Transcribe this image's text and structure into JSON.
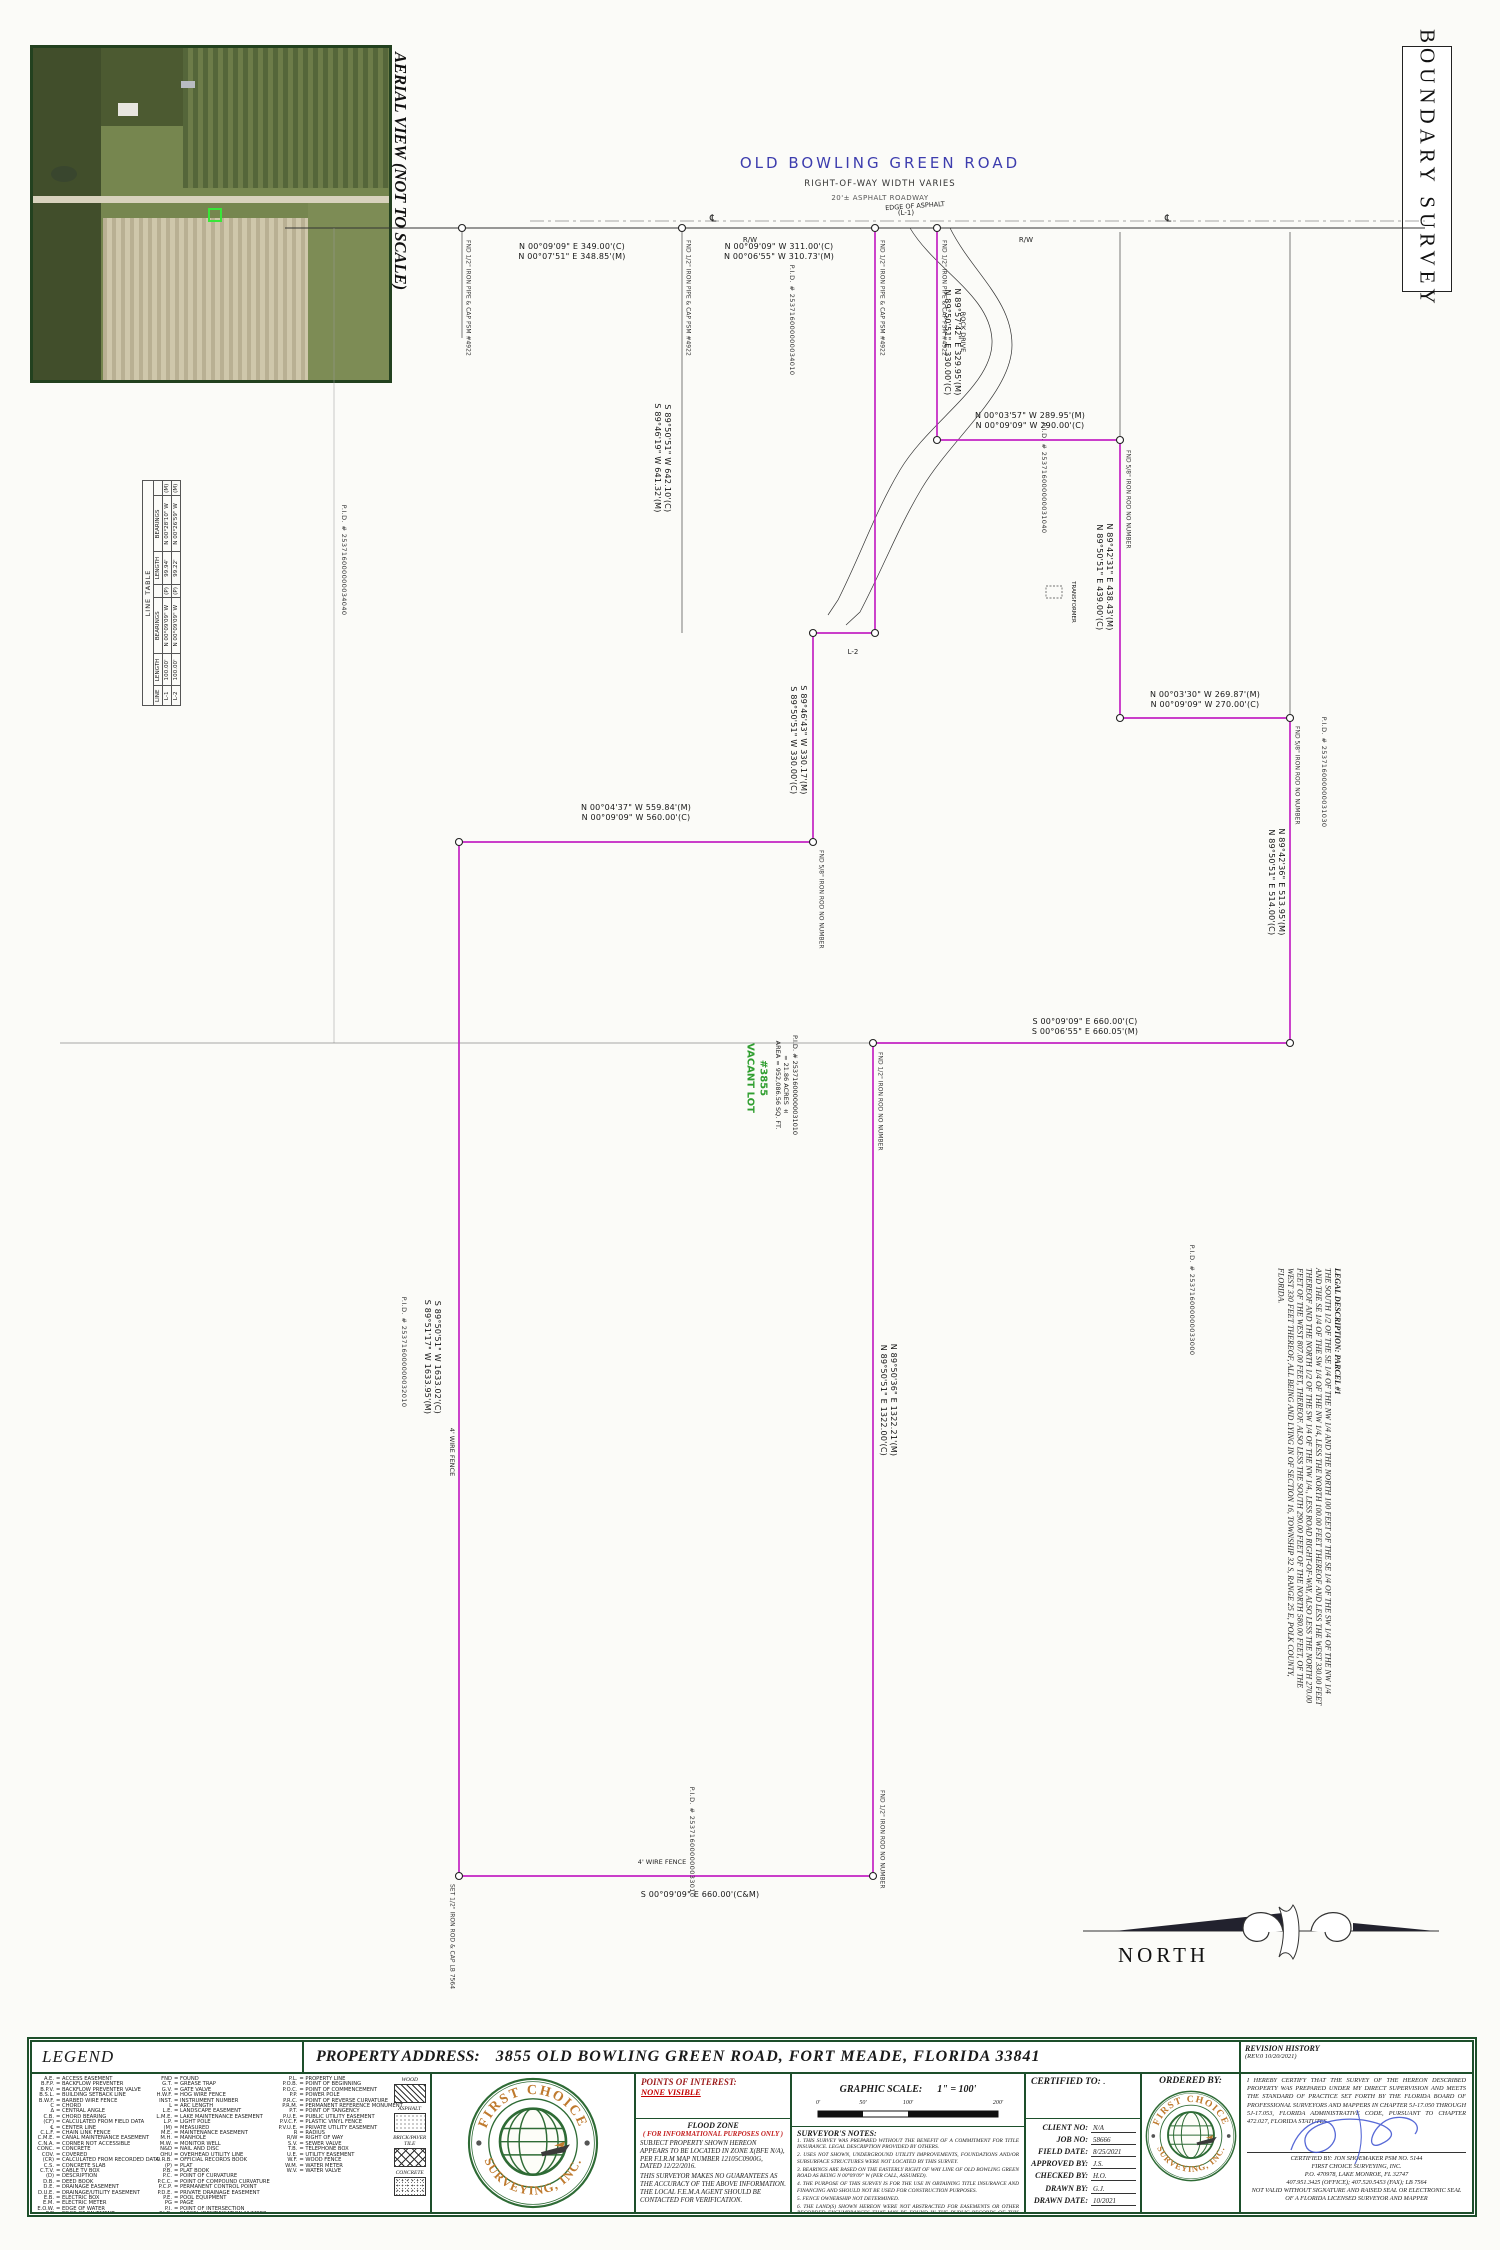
{
  "sheet": {
    "title": "BOUNDARY SURVEY",
    "aerial_caption": "AERIAL VIEW (NOT TO SCALE)",
    "north_label": "NORTH"
  },
  "road": {
    "name": "OLD BOWLING GREEN ROAD",
    "row_note": "RIGHT-OF-WAY WIDTH VARIES",
    "surface_note": "20'± ASPHALT ROADWAY",
    "rw_label": "R/W",
    "centerline_symbol": "℄",
    "edge_of_asphalt": "EDGE OF ASPHALT",
    "rock_drive": "ROCK DRIVE",
    "l1_ref": "(L-1)"
  },
  "parcel": {
    "lot_label_1": "VACANT LOT",
    "lot_label_2": "#3855",
    "area_sqft": "AREA = 952,086.56 SQ. FT.",
    "area_acres": "= 21.86 ACRES ±",
    "pid": "P.I.D. # 253716000000031010",
    "l2_label": "L-2",
    "wire_fence": "4' WIRE FENCE",
    "transformer": "TRANSFORMER",
    "boundary_color": "#c323c3"
  },
  "measurements": [
    {
      "line1": "N 00°09'09\" E   349.00'(C)",
      "line2": "N 00°07'51\" E   348.85'(M)"
    },
    {
      "line1": "N 00°09'09\" W   311.00'(C)",
      "line2": "N 00°06'55\" W   310.73'(M)"
    },
    {
      "line1": "N 89°57'42\" E   329.95'(M)",
      "line2": "N 89°50'51\" E   330.00'(C)"
    },
    {
      "line1": "S 89°50'51\" W   642.10'(C)",
      "line2": "S 89°46'19\" W   641.32'(M)"
    },
    {
      "line1": "N 00°03'57\" W   289.95'(M)",
      "line2": "N 00°09'09\" W   290.00'(C)"
    },
    {
      "line1": "N 89°42'31\" E   438.43'(M)",
      "line2": "N 89°50'51\" E   439.00'(C)"
    },
    {
      "line1": "N 00°03'30\" W   269.87'(M)",
      "line2": "N 00°09'09\" W   270.00'(C)"
    },
    {
      "line1": "N 89°42'36\" E   513.95'(M)",
      "line2": "N 89°50'51\" E   514.00'(C)"
    },
    {
      "line1": "S 00°09'09\" E   660.00'(C)",
      "line2": "S 00°06'55\" E   660.05'(M)"
    },
    {
      "line1": "N 00°04'37\" W   559.84'(M)",
      "line2": "N 00°09'09\" W   560.00'(C)"
    },
    {
      "line1": "S 89°46'43\" W   330.17'(M)",
      "line2": "S 89°50'51\" W   330.00'(C)"
    },
    {
      "line1": "S 89°50'51\" W   1633.02'(C)",
      "line2": "S 89°51'17\" W   1633.95'(M)"
    },
    {
      "line1": "N 89°50'36\" E   1322.21'(M)",
      "line2": "N 89°50'51\" E   1322.00'(C)"
    },
    {
      "line1": "S 00°09'09\" E   660.00'(C&M)",
      "line2": ""
    }
  ],
  "monument_labels": [
    "FND 1/2\" IRON PIPE & CAP PSM #4922",
    "FND 5/8\" IRON ROD NO NUMBER",
    "FND 1/2\" IRON ROD NO NUMBER",
    "SET 1/2\" IRON ROD & CAP LB 7564"
  ],
  "pid_labels": [
    "P.I.D. # 253716000000034040",
    "P.I.D. # 253716000000034010",
    "P.I.D. # 253716000000031040",
    "P.I.D. # 253716000000031030",
    "P.I.D. # 253716000000033000",
    "P.I.D. # 253716000000032010",
    "P.I.D. # 253716000000033010"
  ],
  "line_table": {
    "title": "LINE TABLE",
    "headers": [
      "LINE",
      "LENGTH",
      "BEARINGS",
      "",
      "LENGTH",
      "BEARINGS",
      ""
    ],
    "rows": [
      [
        "L-1",
        "100.00'",
        "N 00°09'09\" W",
        "(P)",
        "99.94'",
        "N 00°28'10\" W",
        "(M)"
      ],
      [
        "L-2",
        "100.00'",
        "N 00°09'09\" W",
        "(P)",
        "99.22'",
        "N 00°26'59\" W",
        "(M)"
      ]
    ]
  },
  "legal_description": {
    "title": "LEGAL DESCRIPTION: PARCEL #1",
    "body": "THE SOUTH 1/2 OF THE SE 1/4 OF THE NW 1/4 AND THE NORTH 100 FEET OF THE SE 1/4 OF THE SW 1/4 OF THE NW 1/4 AND THE SE 1/4 OF THE SW 1/4 OF THE NW 1/4, LESS THE NORTH 100.00 FEET THEREOF AND LESS THE WEST 330.00 FEET THEREOF AND THE NORTH 1/2 OF THE SW 1/4 OF THE NW 1/4., LESS ROAD RIGHT-OF-WAY, ALSO LESS THE NORTH 270.00 FEET OF THE WEST 807.00 FEET, THEREOF. ALSO LESS THE SOUTH 290.00 FEET OF THE NORTH 580.00 FEET, OF THE WEST 330 FEET THEREOF, ALL BEING AND LYING IN OF SECTION 16, TOWNSHIP 32 S, RANGE 25 E, POLK COUNTY, FLORIDA."
  },
  "title_block": {
    "legend_title": "LEGEND",
    "property_address_label": "PROPERTY ADDRESS:",
    "property_address_value": "3855 OLD BOWLING GREEN ROAD,  FORT MEADE, FLORIDA 33841",
    "revision_title": "REVISION HISTORY",
    "revision_value": "(REV.0  10/20/2021)",
    "legend_col1": [
      {
        "a": "A.E.",
        "m": "= ACCESS EASEMENT"
      },
      {
        "a": "B.F.P.",
        "m": "= BACKFLOW PREVENTER"
      },
      {
        "a": "B.P.V.",
        "m": "= BACKFLOW PREVENTER VALVE"
      },
      {
        "a": "B.S.L.",
        "m": "= BUILDING SETBACK LINE"
      },
      {
        "a": "B.W.F.",
        "m": "= BARBED WIRE FENCE"
      },
      {
        "a": "C",
        "m": "= CHORD"
      },
      {
        "a": "Δ",
        "m": "= CENTRAL ANGLE"
      },
      {
        "a": "C.B.",
        "m": "= CHORD BEARING"
      },
      {
        "a": "(CF)",
        "m": "= CALCULATED FROM FIELD DATA"
      },
      {
        "a": "℄",
        "m": "= CENTER LINE"
      },
      {
        "a": "C.L.F.",
        "m": "= CHAIN LINK FENCE"
      },
      {
        "a": "C.M.E.",
        "m": "= CANAL MAINTENANCE EASEMENT"
      },
      {
        "a": "C.N.A.",
        "m": "= CORNER NOT ACCESSIBLE"
      },
      {
        "a": "CONC.",
        "m": "= CONCRETE"
      },
      {
        "a": "COV.",
        "m": "= COVERED"
      },
      {
        "a": "(CR)",
        "m": "= CALCULATED FROM RECORDED DATA"
      },
      {
        "a": "C.S.",
        "m": "= CONCRETE SLAB"
      },
      {
        "a": "C.T.V.",
        "m": "= CABLE TV BOX"
      },
      {
        "a": "(D)",
        "m": "= DESCRIPTION"
      },
      {
        "a": "D.B.",
        "m": "= DEED BOOK"
      },
      {
        "a": "D.E.",
        "m": "= DRAINAGE EASEMENT"
      },
      {
        "a": "D.U.E.",
        "m": "= DRAINAGE/UTILITY EASEMENT"
      },
      {
        "a": "E.B.",
        "m": "= ELECTRIC BOX"
      },
      {
        "a": "E.M.",
        "m": "= ELECTRIC METER"
      },
      {
        "a": "E.O.W.",
        "m": "= EDGE OF WATER"
      },
      {
        "a": "E/P",
        "m": "= EDGE OF PAVEMENT"
      }
    ],
    "legend_col2": [
      {
        "a": "FND",
        "m": "= FOUND"
      },
      {
        "a": "G.T.",
        "m": "= GREASE TRAP"
      },
      {
        "a": "G.V.",
        "m": "= GATE VALVE"
      },
      {
        "a": "H.W.F.",
        "m": "= HOG WIRE FENCE"
      },
      {
        "a": "INST.",
        "m": "= INSTRUMENT NUMBER"
      },
      {
        "a": "L",
        "m": "= ARC LENGTH"
      },
      {
        "a": "L.E.",
        "m": "= LANDSCAPE EASEMENT"
      },
      {
        "a": "L.M.E.",
        "m": "= LAKE MAINTENANCE EASEMENT"
      },
      {
        "a": "L.P.",
        "m": "= LIGHT POLE"
      },
      {
        "a": "(M)",
        "m": "= MEASURED"
      },
      {
        "a": "M.E.",
        "m": "= MAINTENANCE EASEMENT"
      },
      {
        "a": "M.H.",
        "m": "= MANHOLE"
      },
      {
        "a": "M.W.",
        "m": "= MONITOR WELL"
      },
      {
        "a": "N&D",
        "m": "= NAIL AND DISC"
      },
      {
        "a": "OHU",
        "m": "= OVERHEAD UTILITY LINE"
      },
      {
        "a": "O.R.B.",
        "m": "= OFFICIAL RECORDS BOOK"
      },
      {
        "a": "(P)",
        "m": "= PLAT"
      },
      {
        "a": "P.B.",
        "m": "= PLAT BOOK"
      },
      {
        "a": "P.C.",
        "m": "= POINT OF CURVATURE"
      },
      {
        "a": "P.C.C.",
        "m": "= POINT OF COMPOUND CURVATURE"
      },
      {
        "a": "P.C.P.",
        "m": "= PERMANENT CONTROL POINT"
      },
      {
        "a": "P.D.E.",
        "m": "= PRIVATE DRAINAGE EASEMENT"
      },
      {
        "a": "P.E.",
        "m": "= POOL EQUIPMENT"
      },
      {
        "a": "PG",
        "m": "= PAGE"
      },
      {
        "a": "P.I.",
        "m": "= POINT OF INTERSECTION"
      },
      {
        "a": "P.I.D.",
        "m": "= PARCEL IDENTIFICATION NUMBER"
      }
    ],
    "legend_col3": [
      {
        "a": "P.L.",
        "m": "= PROPERTY LINE"
      },
      {
        "a": "P.O.B.",
        "m": "= POINT OF BEGINNING"
      },
      {
        "a": "P.O.C.",
        "m": "= POINT OF COMMENCEMENT"
      },
      {
        "a": "P.P.",
        "m": "= POWER POLE"
      },
      {
        "a": "P.R.C.",
        "m": "= POINT OF REVERSE CURVATURE"
      },
      {
        "a": "P.R.M.",
        "m": "= PERMANENT REFERENCE MONUMENT"
      },
      {
        "a": "P.T.",
        "m": "= POINT OF TANGENCY"
      },
      {
        "a": "P.U.E.",
        "m": "= PUBLIC UTILITY EASEMENT"
      },
      {
        "a": "P.V.C.F.",
        "m": "= PLASTIC VINYL FENCE"
      },
      {
        "a": "P.V.U.E.",
        "m": "= PRIVATE UTILITY EASEMENT"
      },
      {
        "a": "R",
        "m": "= RADIUS"
      },
      {
        "a": "R/W",
        "m": "= RIGHT OF WAY"
      },
      {
        "a": "S.V.",
        "m": "= SEWER VALVE"
      },
      {
        "a": "T.B.",
        "m": "= TELEPHONE BOX"
      },
      {
        "a": "U.E.",
        "m": "= UTILITY EASEMENT"
      },
      {
        "a": "W.F.",
        "m": "= WOOD FENCE"
      },
      {
        "a": "W.M.",
        "m": "= WATER METER"
      },
      {
        "a": "W.V.",
        "m": "= WATER VALVE"
      }
    ],
    "swatches": [
      "WOOD",
      "ASPHALT",
      "BRICK/PAVER TILE",
      "CONCRETE"
    ],
    "logo": {
      "arc_top": "FIRST CHOICE",
      "arc_bottom": "SURVEYING, INC."
    },
    "poi_label": "POINTS OF INTEREST:",
    "poi_value": "NONE VISIBLE",
    "flood": {
      "h1": "FLOOD ZONE",
      "h2": "( FOR INFORMATIONAL PURPOSES ONLY )",
      "p1": "SUBJECT PROPERTY SHOWN HEREON APPEARS TO BE LOCATED IN ZONE X(BFE N/A), PER F.I.R.M MAP NUMBER 12105C0900G, DATED 12/22/2016.",
      "p2": "THIS SURVEYOR MAKES NO GUARANTEES AS THE ACCURACY OF THE ABOVE INFORMATION. THE LOCAL F.E.M.A AGENT SHOULD BE CONTACTED FOR VERIFICATION."
    },
    "scale": {
      "label": "GRAPHIC SCALE:",
      "value": "1\" = 100'",
      "ticks": [
        "0'",
        "50'",
        "100'",
        "200'"
      ]
    },
    "notes_title": "SURVEYOR'S NOTES:",
    "notes": [
      "1. THIS SURVEY WAS PREPARED WITHOUT THE BENEFIT OF A COMMITMENT FOR TITLE INSURANCE. LEGAL DESCRIPTION PROVIDED BY OTHERS.",
      "2. USES NOT SHOWN, UNDERGROUND UTILITY IMPROVEMENTS, FOUNDATIONS AND/OR SUBSURFACE STRUCTURES WERE NOT LOCATED BY THIS SURVEY.",
      "3. BEARINGS ARE BASED ON THE EASTERLY RIGHT OF WAY LINE OF OLD BOWLING GREEN ROAD AS BEING N 00°09'09\" W (PER CALL, ASSUMED).",
      "4. THE PURPOSE OF THIS SURVEY IS FOR THE USE IN OBTAINING TITLE INSURANCE AND FINANCING AND SHOULD NOT BE USED FOR CONSTRUCTION PURPOSES.",
      "5. FENCE OWNERSHIP NOT DETERMINED.",
      "6. THE LAND(S) SHOWN HEREON WERE NOT ABSTRACTED FOR EASEMENTS OR OTHER RECORDED ENCUMBRANCES THAT MAY BE FOUND IN THE PUBLIC RECORDS OF THIS COUNTY."
    ],
    "certified_to_label": "CERTIFIED TO:",
    "certified_to_value": ".",
    "client_rows": [
      {
        "label": "CLIENT NO:",
        "value": "N/A"
      },
      {
        "label": "JOB NO:",
        "value": "58666"
      },
      {
        "label": "FIELD DATE:",
        "value": "8/25/2021"
      },
      {
        "label": "APPROVED BY:",
        "value": "J.S."
      },
      {
        "label": "CHECKED BY:",
        "value": "H.O."
      },
      {
        "label": "DRAWN BY:",
        "value": "G.J."
      },
      {
        "label": "DRAWN DATE:",
        "value": "10/2021"
      }
    ],
    "ordered_by_label": "ORDERED BY:",
    "cert_paragraph": "I HEREBY CERTIFY THAT THE SURVEY OF THE HEREON DESCRIBED PROPERTY WAS PREPARED UNDER MY DIRECT SUPERVISION AND MEETS THE STANDARD OF PRACTICE SET FORTH BY THE FLORIDA BOARD OF PROFESSIONAL SURVEYORS AND MAPPERS IN CHAPTER 5J-17.050 THROUGH 5J-17.053, FLORIDA ADMINISTRATIVE CODE, PURSUANT TO CHAPTER 472.027, FLORIDA STATUTES.",
    "cert_lines": [
      "CERTIFIED BY: JON SHOEMAKER PSM NO. 5144",
      "FIRST CHOICE SURVEYING, INC.",
      "P.O. 470978, LAKE MONROE, FL 32747",
      "407.951.3425 (OFFICE); 407.520.5453 (FAX); LB 7564",
      "NOT VALID WITHOUT SIGNATURE AND RAISED SEAL OR ELECTRONIC SEAL",
      "OF A FLORIDA LICENSED SURVEYOR AND MAPPER"
    ]
  }
}
